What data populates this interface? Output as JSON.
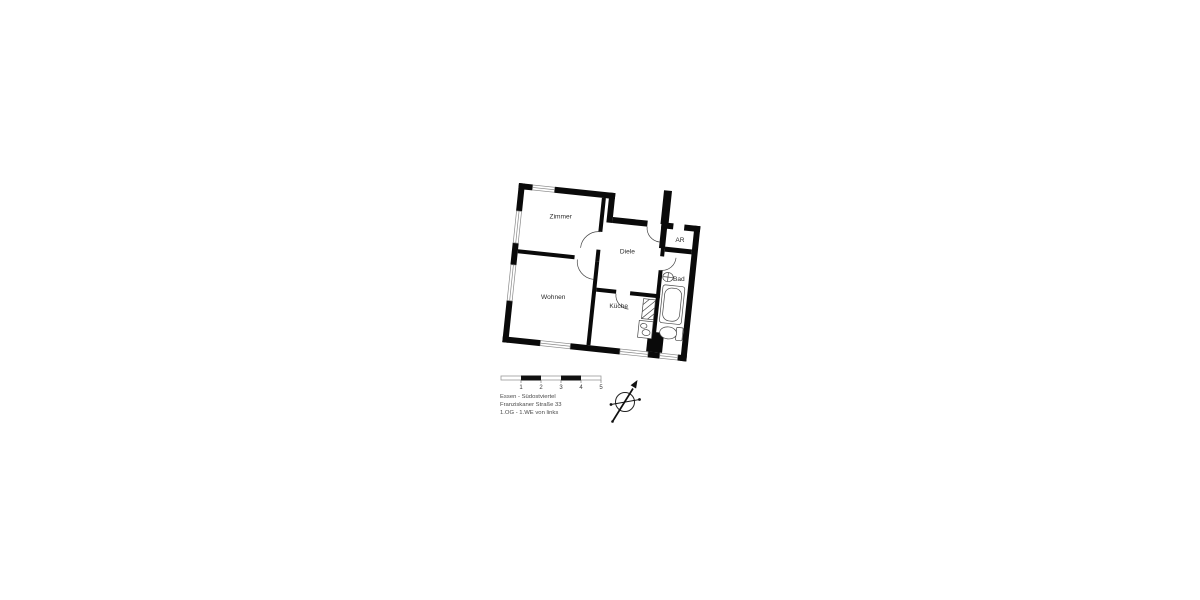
{
  "floor_plan": {
    "rooms": [
      {
        "id": "zimmer",
        "label": "Zimmer"
      },
      {
        "id": "wohnen",
        "label": "Wohnen"
      },
      {
        "id": "diele",
        "label": "Diele"
      },
      {
        "id": "kueche",
        "label": "Küche"
      },
      {
        "id": "ar",
        "label": "AR"
      },
      {
        "id": "bad",
        "label": "Bad"
      }
    ],
    "colors": {
      "wall": "#0a0a0a",
      "fixture_line": "#474747",
      "window_line": "#8a8a8a"
    }
  },
  "scale_bar": {
    "ticks": [
      "1",
      "2",
      "3",
      "4",
      "5"
    ]
  },
  "title_block": {
    "line1": "Essen - Südostviertel",
    "line2": "Franziskaner Straße 33",
    "line3": "1.OG - 1.WE von links"
  }
}
